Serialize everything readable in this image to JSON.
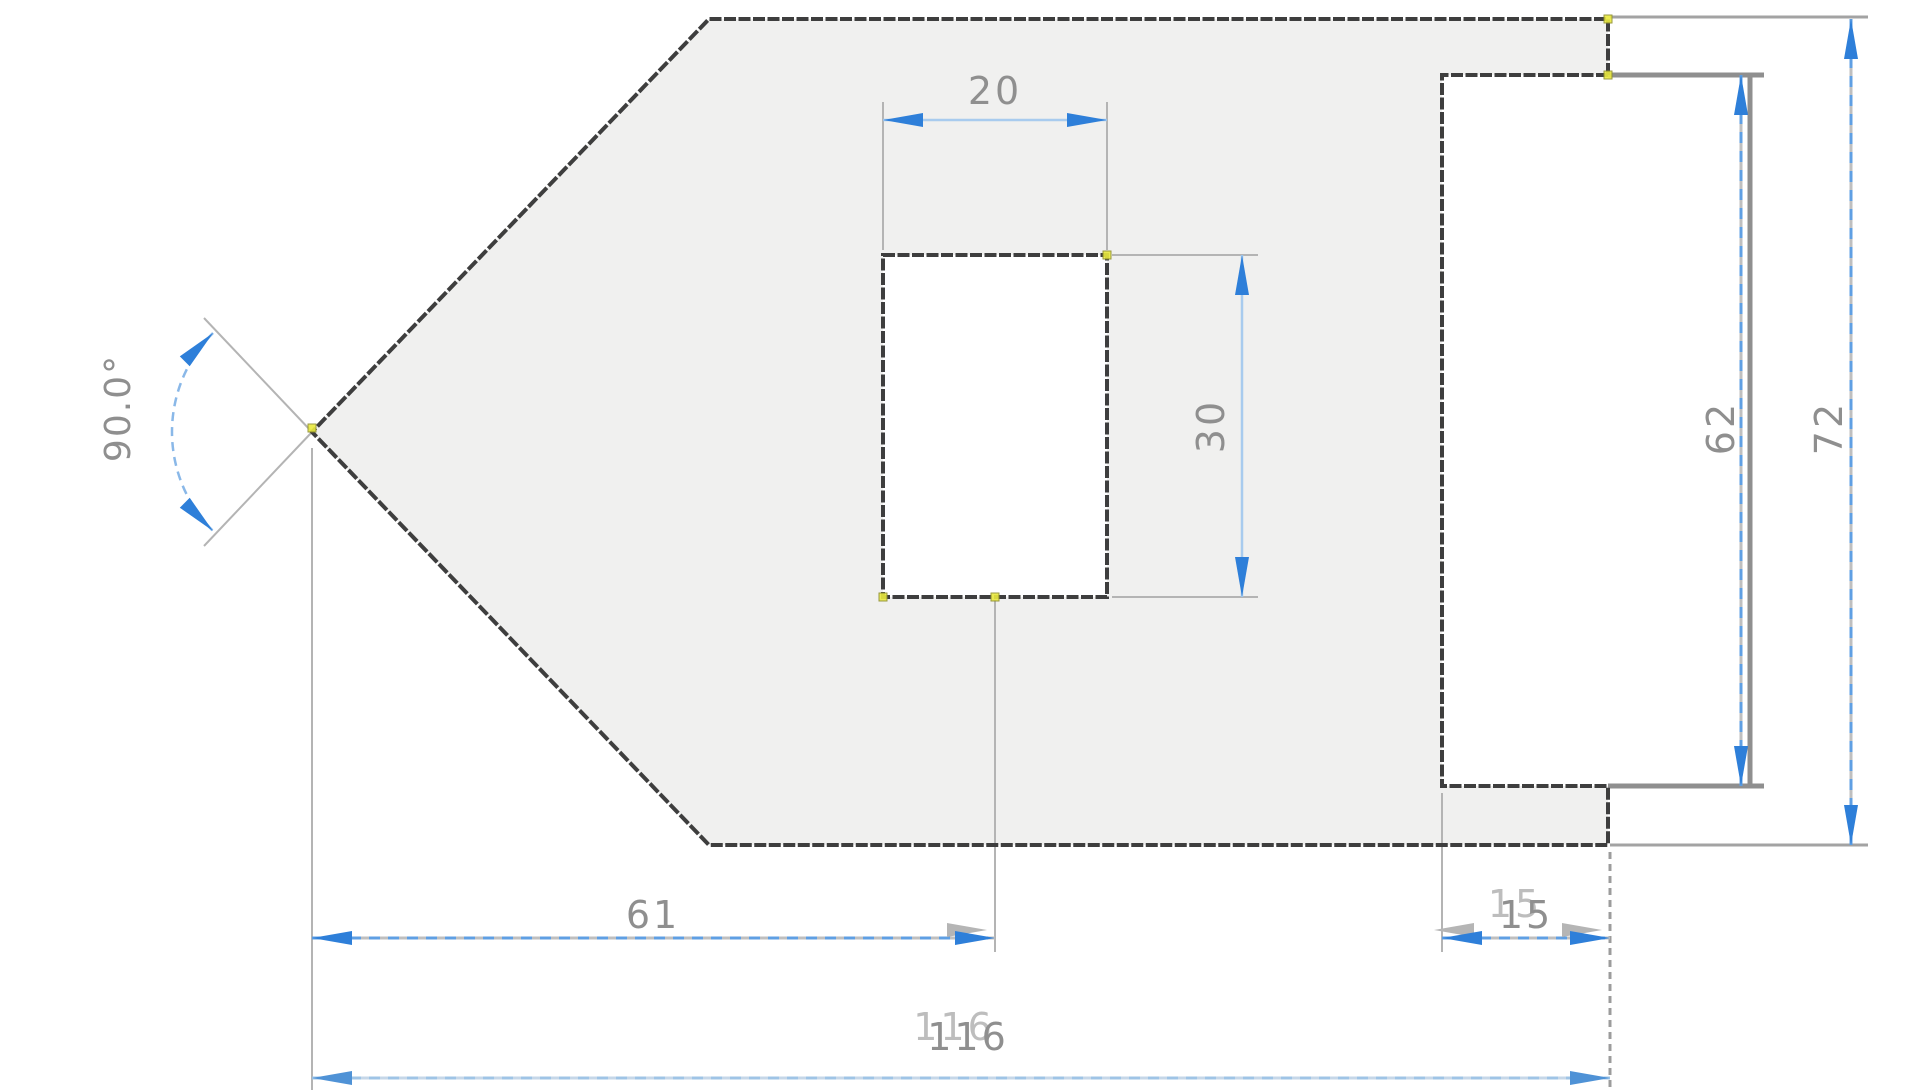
{
  "canvas": {
    "type": "cad-2d-sketch",
    "background": "#ffffff"
  },
  "sketch": {
    "shapes": [
      "pentagon-profile",
      "inner-rect-cutout",
      "right-rectangle-tab"
    ]
  },
  "dimensions": {
    "inner_rect_width": {
      "value": "20",
      "orientation": "horizontal"
    },
    "inner_rect_height": {
      "value": "30",
      "orientation": "vertical"
    },
    "left_vertex_angle": {
      "value": "90.0°",
      "type": "angular"
    },
    "vertex_to_inner_rect": {
      "value": "61",
      "orientation": "horizontal"
    },
    "overlap_width": {
      "value": "15",
      "orientation": "horizontal"
    },
    "overall_length": {
      "value": "116",
      "orientation": "horizontal"
    },
    "right_rect_height": {
      "value": "62",
      "orientation": "vertical"
    },
    "overall_height": {
      "value": "72",
      "orientation": "vertical"
    }
  },
  "colors": {
    "dimension_accent": "#2e7fd9",
    "selected_dash": "#5f9fe3",
    "dimension_text": "#8f8f8f",
    "sketch_line": "#3e3e3e",
    "model_edge": "#8f8f8f",
    "region_fill": "#f0f0ef",
    "constraint_marker": "#e9e93f"
  }
}
